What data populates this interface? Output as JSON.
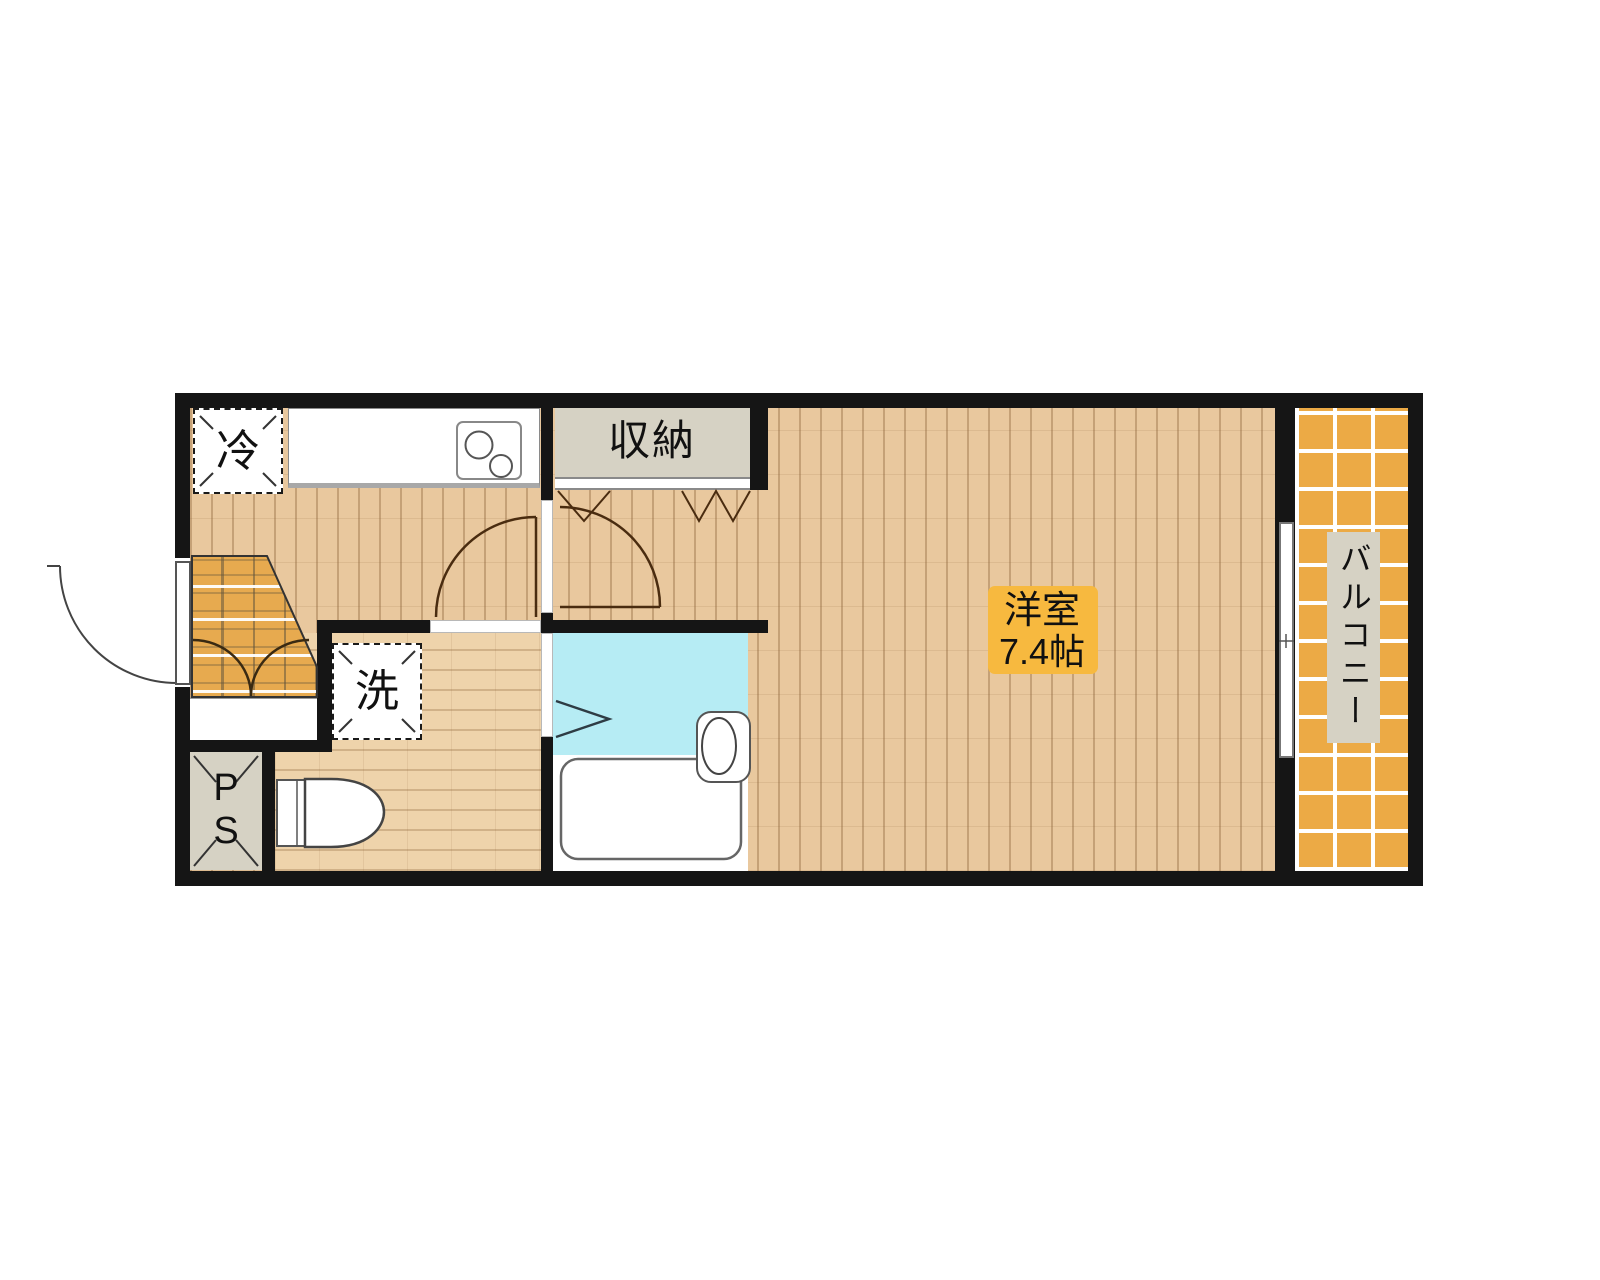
{
  "plan": {
    "type": "apartment-floor-plan",
    "labels": {
      "refrigerator": "冷",
      "storage": "収納",
      "washer": "洗",
      "pipe_space_line1": "P",
      "pipe_space_line2": "S",
      "main_room_name": "洋室",
      "main_room_size": "7.4帖",
      "balcony": "バルコニー"
    },
    "colors": {
      "wall": "#151515",
      "wood_floor": "#e9c89e",
      "washroom_floor": "#eed3ab",
      "bathroom_floor": "#b6ecf4",
      "balcony_tile": "#ecaa45",
      "entrance_tile": "#e7aa4f",
      "fixture_fill": "#d6d2c4",
      "room_label_bg": "#f7b93f",
      "door_arc": "#4a2c10"
    }
  }
}
